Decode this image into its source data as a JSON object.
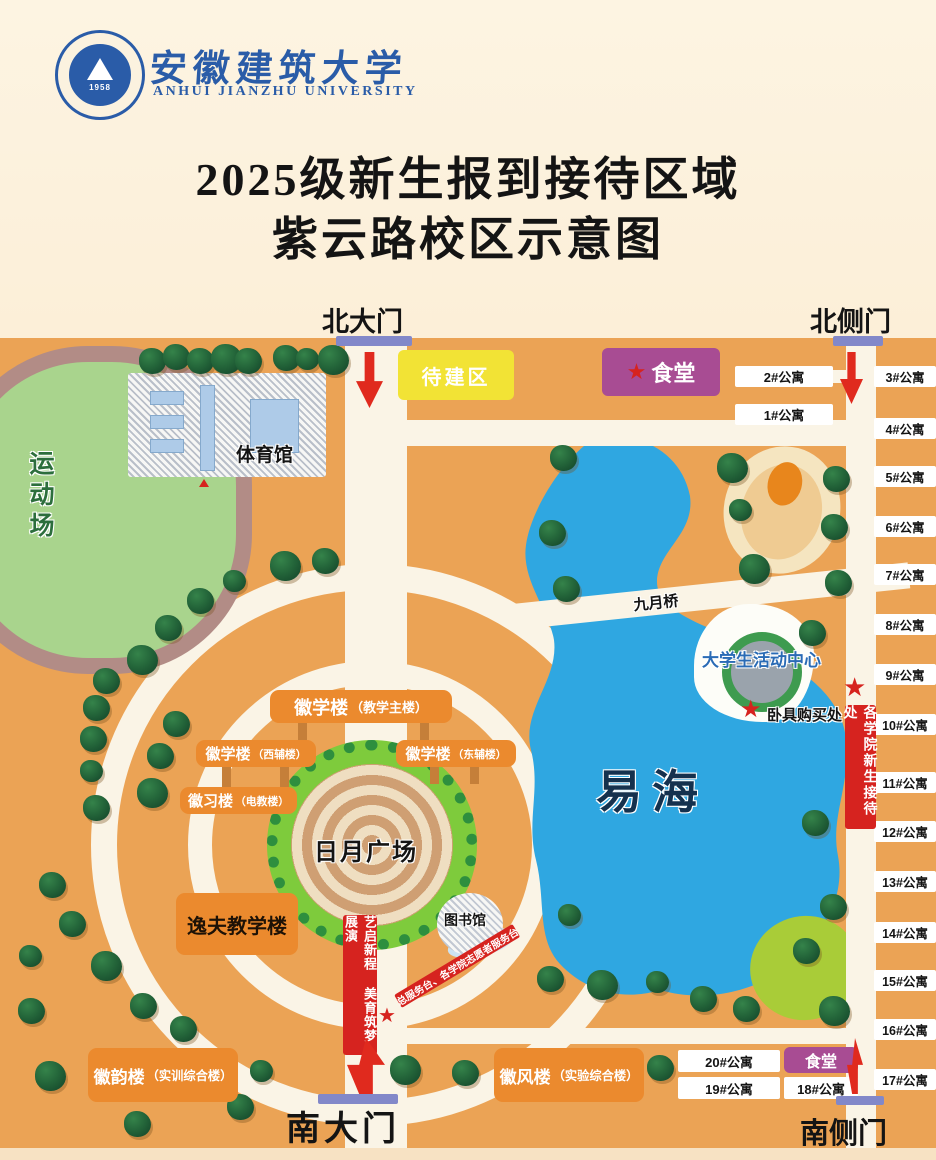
{
  "header": {
    "seal_year": "1958",
    "university_cn": "安徽建筑大学",
    "university_en": "ANHUI JIANZHU UNIVERSITY"
  },
  "title": {
    "line1": "2025级新生报到接待区域",
    "line2": "紫云路校区示意图"
  },
  "gates": {
    "north": "北大门",
    "north_side": "北侧门",
    "south": "南大门",
    "south_side": "南侧门"
  },
  "places": {
    "sports_field": "运动场",
    "gym": "体育馆",
    "tbd_area": "待建区",
    "canteen_north": "食堂",
    "canteen_south": "食堂",
    "bridge": "九月桥",
    "lake": "易海",
    "activity_center": "大学生活动中心",
    "bedding_point": "卧具购买处",
    "reception_banner": "各学院新生接待处",
    "stage_banner": "艺启新程 美育筑梦展演",
    "service_banner": "总服务台、各学院志愿者服务台",
    "library": "图书馆",
    "plaza": "日月广场",
    "yifu_building": "逸夫教学楼",
    "huixue_main": {
      "name": "徽学楼",
      "sub": "（教学主楼）"
    },
    "huixue_west": {
      "name": "徽学楼",
      "sub": "（西辅楼）"
    },
    "huixue_east": {
      "name": "徽学楼",
      "sub": "（东辅楼）"
    },
    "huixi": {
      "name": "徽习楼",
      "sub": "（电教楼）"
    },
    "huiyun": {
      "name": "徽韵楼",
      "sub": "（实训综合楼）"
    },
    "huifeng": {
      "name": "徽风楼",
      "sub": "（实验综合楼）"
    }
  },
  "apartments": {
    "north": [
      "2#公寓",
      "1#公寓"
    ],
    "south": [
      "20#公寓",
      "19#公寓",
      "18#公寓"
    ],
    "right": [
      {
        "label": "3#公寓",
        "y": 28
      },
      {
        "label": "4#公寓",
        "y": 80
      },
      {
        "label": "5#公寓",
        "y": 128
      },
      {
        "label": "6#公寓",
        "y": 178
      },
      {
        "label": "7#公寓",
        "y": 226
      },
      {
        "label": "8#公寓",
        "y": 276
      },
      {
        "label": "9#公寓",
        "y": 326
      },
      {
        "label": "10#公寓",
        "y": 376
      },
      {
        "label": "11#公寓",
        "y": 434
      },
      {
        "label": "12#公寓",
        "y": 483
      },
      {
        "label": "13#公寓",
        "y": 533
      },
      {
        "label": "14#公寓",
        "y": 584
      },
      {
        "label": "15#公寓",
        "y": 632
      },
      {
        "label": "16#公寓",
        "y": 681
      },
      {
        "label": "17#公寓",
        "y": 731
      }
    ]
  },
  "colors": {
    "map_orange": "#EBA355",
    "road_cream": "#FAF4E6",
    "lake_blue": "#2FA7E1",
    "building_orange": "#EB8A2E",
    "banner_red": "#D6231F",
    "canteen_purple": "#A84C93",
    "tbd_yellow": "#F2E335",
    "gate_purple": "#8288C9",
    "field_green": "#A9D48D",
    "track_mauve": "#B28C86",
    "plaza_green": "#7ECB3C",
    "tree_green": "#1C5631",
    "activity_text_blue": "#2A6BB5"
  },
  "map": {
    "trees": [
      [
        152,
        22
      ],
      [
        176,
        18
      ],
      [
        200,
        22
      ],
      [
        224,
        18
      ],
      [
        248,
        22
      ],
      [
        286,
        19
      ],
      [
        309,
        22
      ],
      [
        331,
        19
      ],
      [
        563,
        119
      ],
      [
        552,
        194
      ],
      [
        566,
        250
      ],
      [
        730,
        127
      ],
      [
        836,
        140
      ],
      [
        742,
        173
      ],
      [
        834,
        188
      ],
      [
        752,
        228
      ],
      [
        838,
        244
      ],
      [
        812,
        294
      ],
      [
        325,
        222
      ],
      [
        283,
        225
      ],
      [
        236,
        244
      ],
      [
        200,
        262
      ],
      [
        168,
        289
      ],
      [
        140,
        319
      ],
      [
        106,
        342
      ],
      [
        96,
        369
      ],
      [
        93,
        400
      ],
      [
        93,
        434
      ],
      [
        96,
        469
      ],
      [
        176,
        385
      ],
      [
        160,
        417
      ],
      [
        150,
        452
      ],
      [
        52,
        546
      ],
      [
        72,
        585
      ],
      [
        32,
        619
      ],
      [
        104,
        625
      ],
      [
        31,
        672
      ],
      [
        143,
        667
      ],
      [
        183,
        690
      ],
      [
        48,
        735
      ],
      [
        137,
        785
      ],
      [
        263,
        734
      ],
      [
        240,
        768
      ],
      [
        403,
        729
      ],
      [
        465,
        734
      ],
      [
        660,
        729
      ],
      [
        550,
        640
      ],
      [
        600,
        644
      ],
      [
        659,
        645
      ],
      [
        703,
        660
      ],
      [
        746,
        670
      ],
      [
        832,
        670
      ],
      [
        806,
        612
      ],
      [
        833,
        568
      ],
      [
        815,
        484
      ],
      [
        571,
        578
      ]
    ]
  }
}
